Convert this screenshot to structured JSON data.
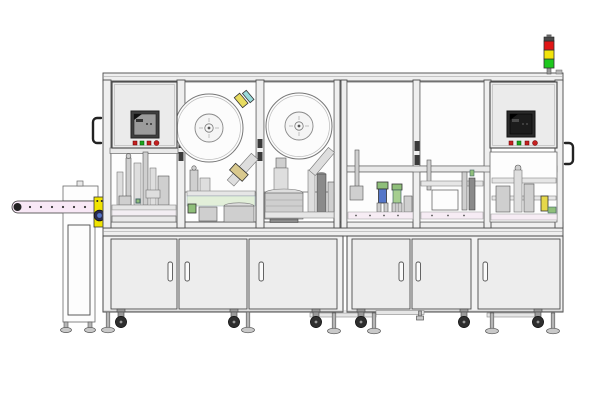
{
  "colors": {
    "background": "#ffffff",
    "outline": "#4a4a4a",
    "frame_fill": "#efefef",
    "glass_fill": "#fdfdfd",
    "conveyor_belt": "#f8e8f6",
    "bracket_yellow": "#f0e400",
    "machinery_green": "#8fbf7a",
    "machinery_blue": "#5576c8",
    "machinery_tan": "#d9c98e",
    "pale_green_band": "#e2efd9",
    "screen_left": "#9c9c9c",
    "screen_right": "#1c1c1c",
    "button_red": "#c42020",
    "button_green": "#1da41d"
  },
  "machine": {
    "signal_tower": {
      "lights": [
        {
          "name": "red",
          "color": "#e01616"
        },
        {
          "name": "yellow",
          "color": "#f2e40c"
        },
        {
          "name": "green",
          "color": "#1ec81e"
        }
      ]
    },
    "left_control_panel": {
      "buttons": [
        {
          "name": "red-square",
          "color": "#c42020"
        },
        {
          "name": "green-square",
          "color": "#1da41d"
        },
        {
          "name": "red-square",
          "color": "#c42020"
        },
        {
          "name": "red-round",
          "color": "#c42020"
        }
      ]
    },
    "right_control_panel": {
      "buttons": [
        {
          "name": "red-square",
          "color": "#c42020"
        },
        {
          "name": "green-square",
          "color": "#1da41d"
        },
        {
          "name": "red-square",
          "color": "#c42020"
        },
        {
          "name": "red-round",
          "color": "#c42020"
        }
      ]
    },
    "reels": {
      "count": 2
    },
    "cabinet_doors": {
      "left": 3,
      "right": 3
    },
    "conveyor": {
      "dot_count": 7,
      "belt_color": "#f8e8f6"
    }
  }
}
